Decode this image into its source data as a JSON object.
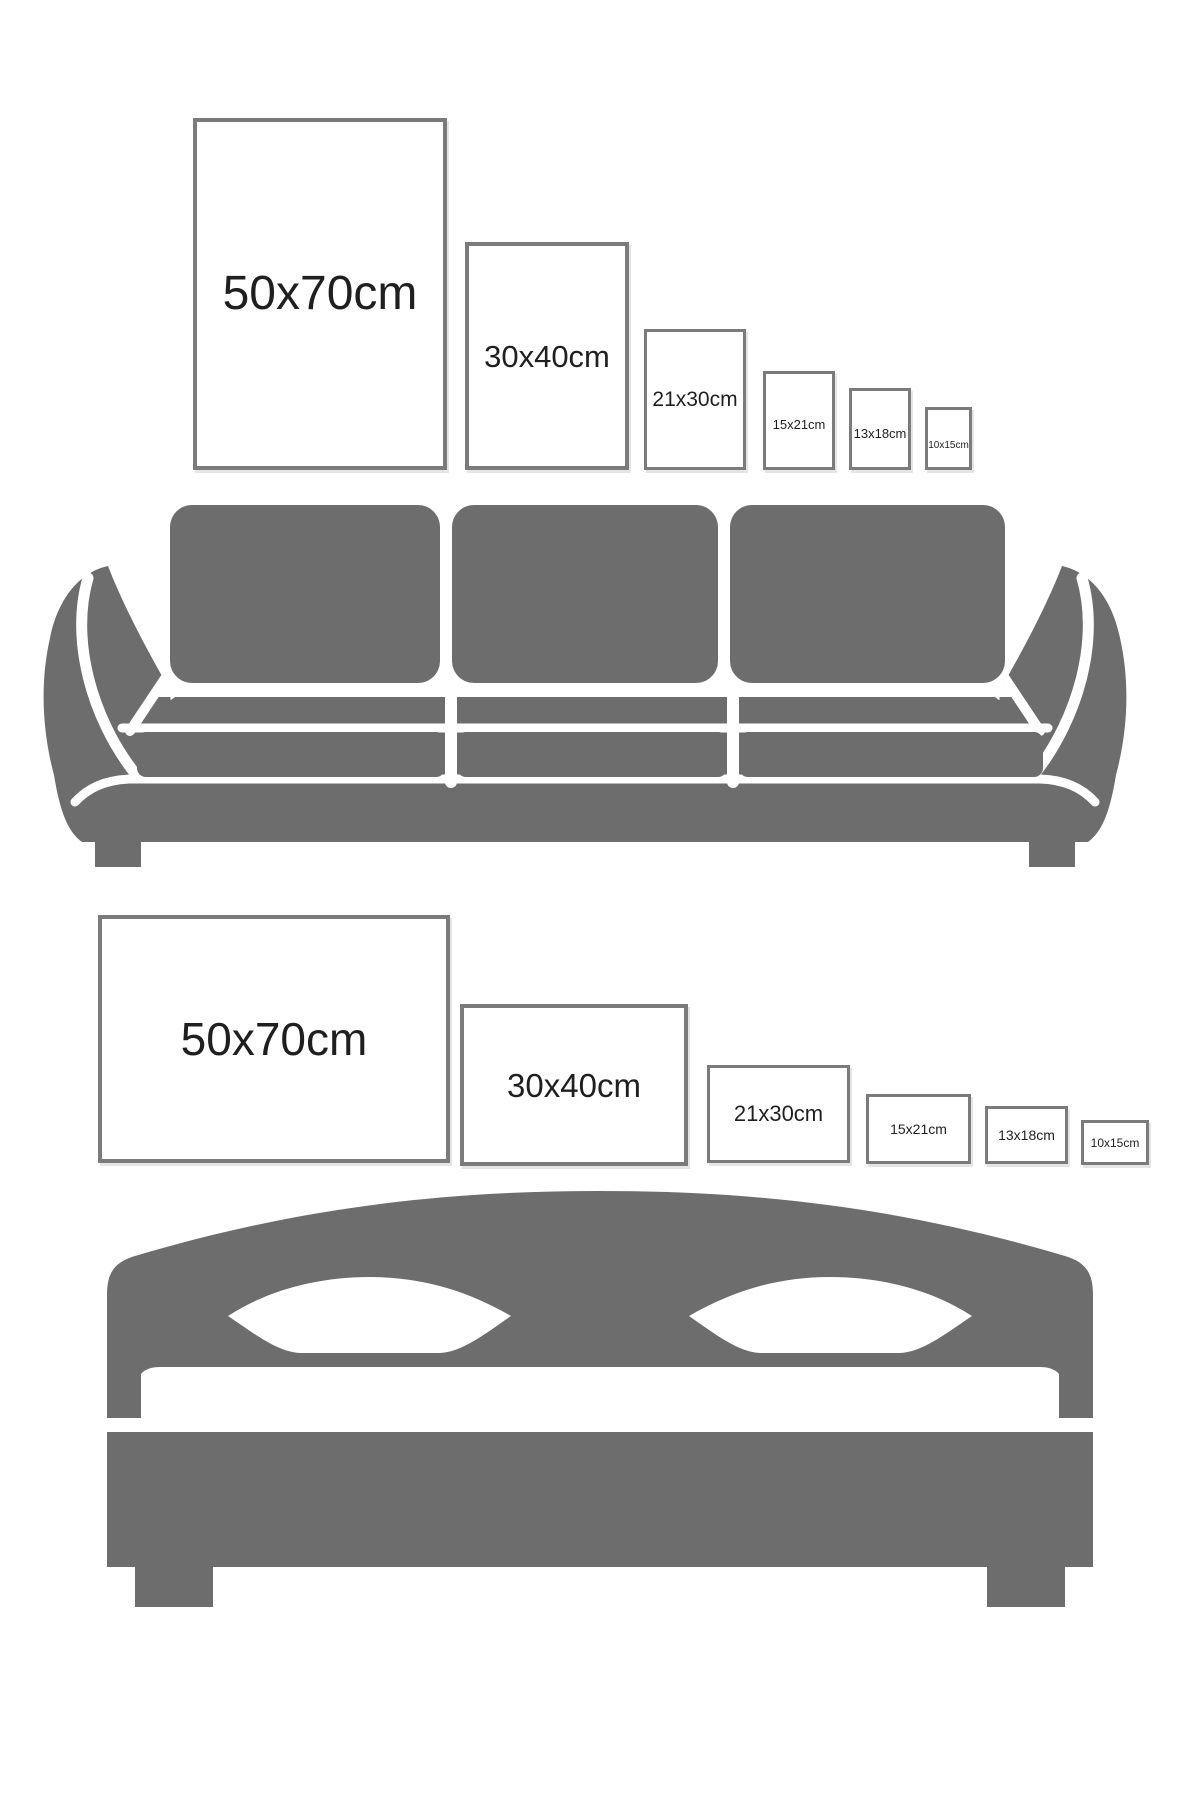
{
  "page": {
    "kind": "poster size comparison guide",
    "background": "#ffffff"
  },
  "colors": {
    "furniture_gray": "#6d6d6d",
    "frame_border": "#7b7b7b",
    "label_text": "#1f1f1f"
  },
  "sofa_section": {
    "orientation": "portrait",
    "icon": "sofa-icon",
    "frames": [
      {
        "label": "50x70cm"
      },
      {
        "label": "30x40cm"
      },
      {
        "label": "21x30cm"
      },
      {
        "label": "15x21cm"
      },
      {
        "label": "13x18cm"
      },
      {
        "label": "10x15cm"
      }
    ]
  },
  "bed_section": {
    "orientation": "landscape",
    "icon": "bed-icon",
    "frames": [
      {
        "label": "50x70cm"
      },
      {
        "label": "30x40cm"
      },
      {
        "label": "21x30cm"
      },
      {
        "label": "15x21cm"
      },
      {
        "label": "13x18cm"
      },
      {
        "label": "10x15cm"
      }
    ]
  }
}
